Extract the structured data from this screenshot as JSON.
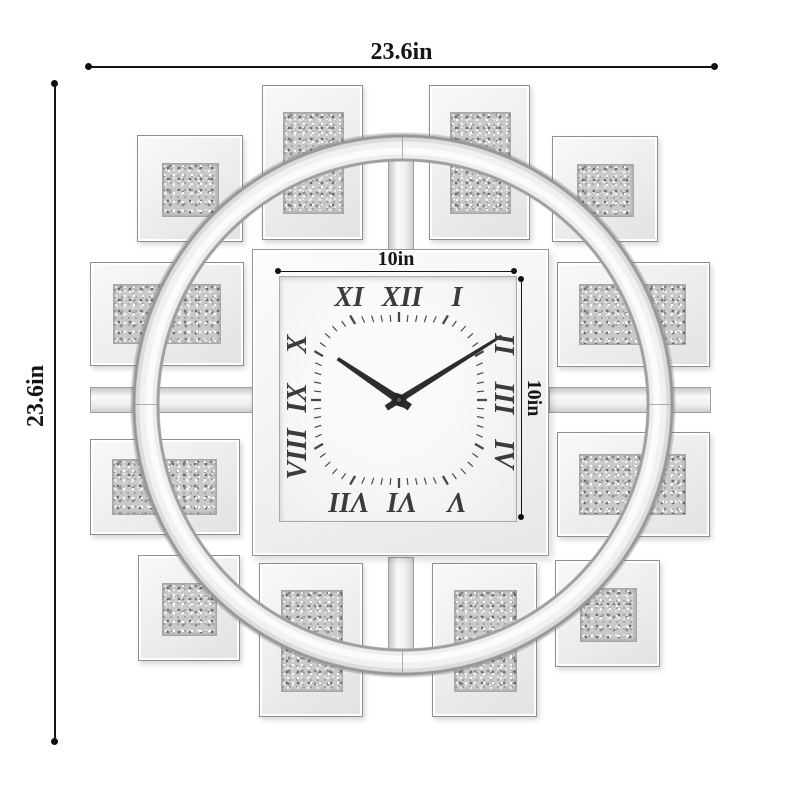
{
  "title": "Crushed-diamond mirrored square wall clock — dimension diagram",
  "annotations": {
    "overall_width_label": "23.6in",
    "overall_height_label": "23.6in",
    "face_width_label": "10in",
    "face_height_label": "10in"
  },
  "clock": {
    "time_shown": "10:09",
    "hands": {
      "hour_angle_deg": 304,
      "minute_angle_deg": 58
    },
    "numerals": [
      {
        "label": "XI",
        "x": 69,
        "y": 21,
        "rot": 0
      },
      {
        "label": "XII",
        "x": 122,
        "y": 21,
        "rot": 0
      },
      {
        "label": "I",
        "x": 177,
        "y": 21,
        "rot": 0
      },
      {
        "label": "II",
        "x": 223,
        "y": 67,
        "rot": 90
      },
      {
        "label": "III",
        "x": 223,
        "y": 121,
        "rot": 90
      },
      {
        "label": "IV",
        "x": 223,
        "y": 177,
        "rot": 90
      },
      {
        "label": "V",
        "x": 177,
        "y": 224,
        "rot": 180
      },
      {
        "label": "VI",
        "x": 122,
        "y": 224,
        "rot": 180
      },
      {
        "label": "VII",
        "x": 69,
        "y": 224,
        "rot": 180
      },
      {
        "label": "VIII",
        "x": 18,
        "y": 177,
        "rot": 270
      },
      {
        "label": "IX",
        "x": 18,
        "y": 121,
        "rot": 270
      },
      {
        "label": "X",
        "x": 18,
        "y": 67,
        "rot": 270
      }
    ]
  },
  "colors": {
    "background": "#ffffff",
    "dimension_line": "#151515",
    "mirror_light": "#fafafa",
    "mirror_edge": "#8f8f8f",
    "glitter_base": "#c9c9c9",
    "numeral": "#3b3b3b",
    "hand": "#2d2d2d"
  }
}
